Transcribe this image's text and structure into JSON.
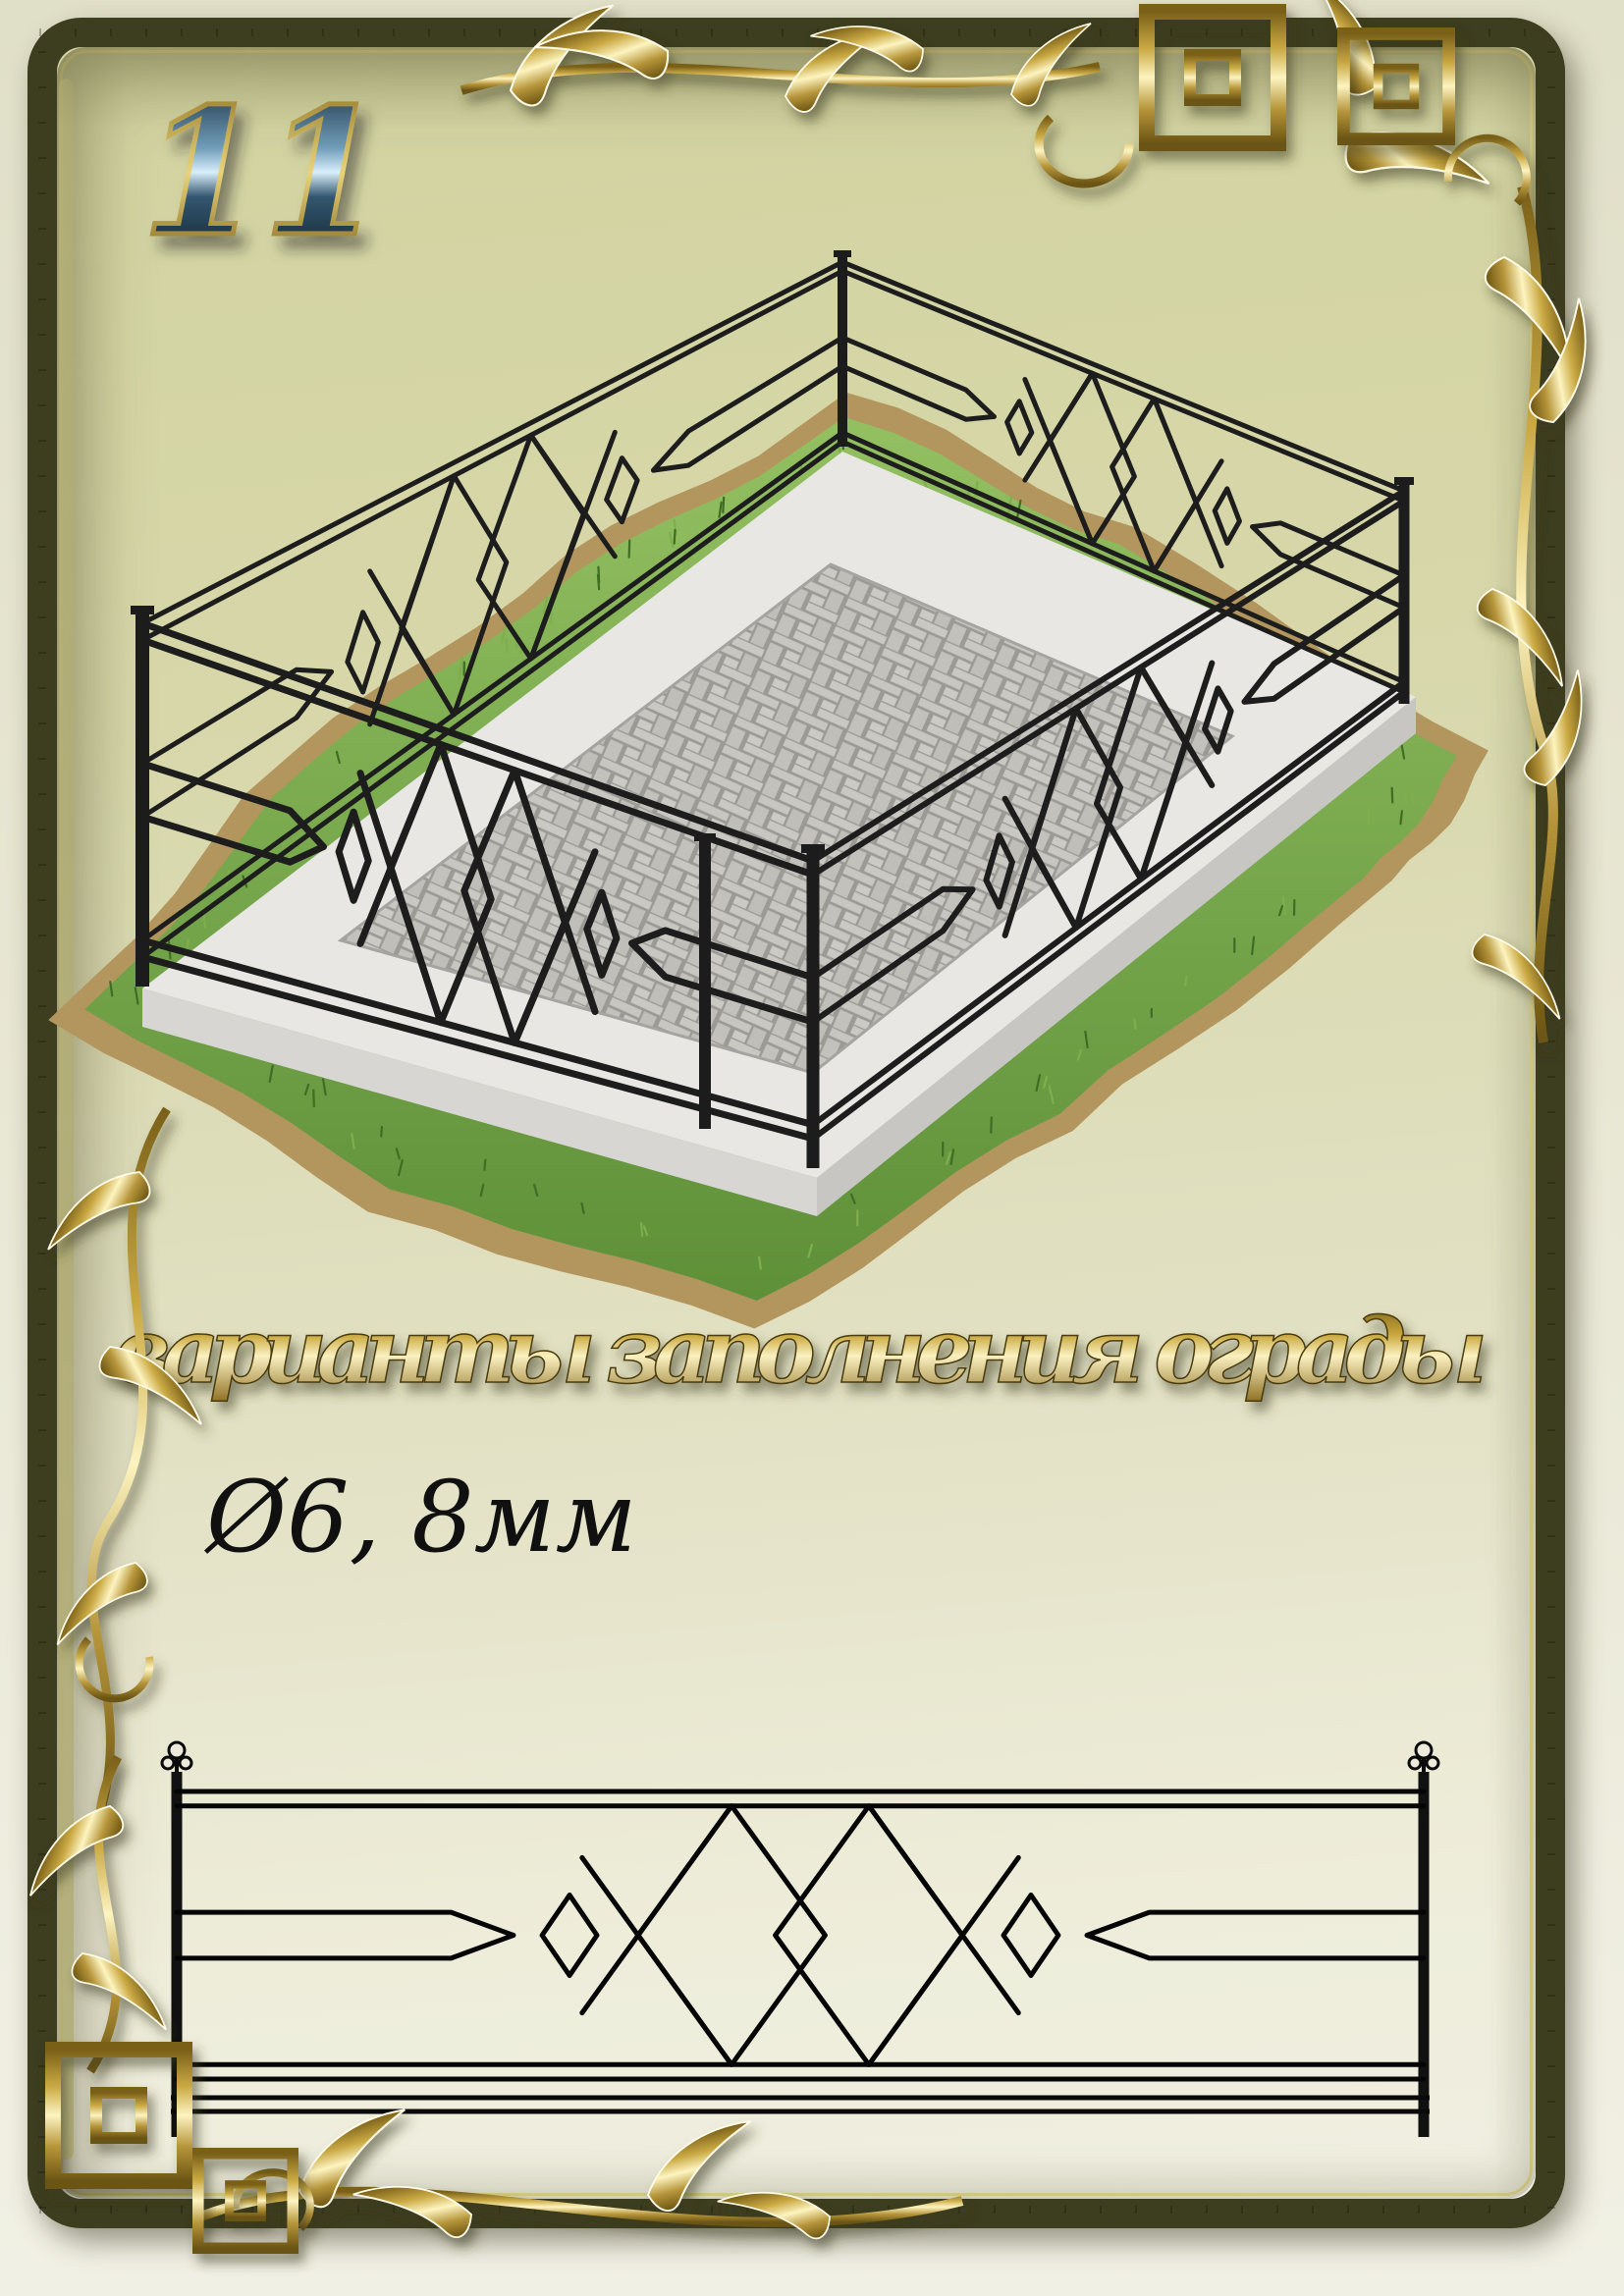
{
  "page": {
    "number": "11"
  },
  "title": {
    "text": "варианты  заполнения  ограды"
  },
  "spec": {
    "diameter_label": "Ø6, 8мм"
  },
  "colors": {
    "frame_olive": "#3d3d1f",
    "gold_accent": "#c9a73c",
    "fence_black": "#1d1d1d",
    "paper_tint": "#d8d8ab"
  }
}
